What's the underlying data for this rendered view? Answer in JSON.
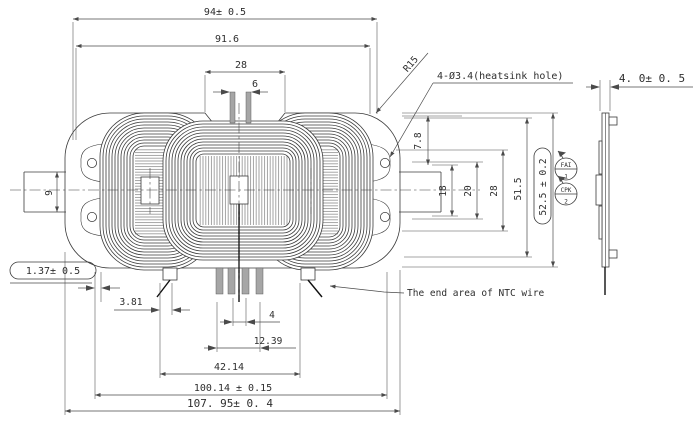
{
  "drawing_type": "engineering-drawing",
  "dimensions": {
    "width_overall": "94± 0.5",
    "width_inner": "91.6",
    "notch_width": "28",
    "pin_spacing": "6",
    "hole_offset": "7.8",
    "core_18": "18",
    "core_20": "20",
    "core_28": "28",
    "height_inner": "51.5",
    "height_overall": "52.5 ± 0.2",
    "stub_width": "9",
    "edge_gap": "1.37± 0.5",
    "tab_offset": "3.81",
    "pin_gap": "4",
    "pin_span": "12.39",
    "tab_span": "42.14",
    "mount_span": "100.14 ± 0.15",
    "total_width": "107. 95± 0. 4",
    "thickness": "4. 0± 0. 5"
  },
  "labels": {
    "radius": "R15",
    "heatsink_hole": "4-Ø3.4(heatsink hole)",
    "ntc_note": "The end area of NTC wire"
  },
  "balloons": {
    "b1_top": "FAI",
    "b1_bottom": "1",
    "b2_top": "CPK",
    "b2_bottom": "2"
  },
  "colors": {
    "line": "#3b3b3b",
    "dim": "#4a4a4a",
    "pin_fill": "#a6a6a6",
    "background": "#ffffff"
  }
}
